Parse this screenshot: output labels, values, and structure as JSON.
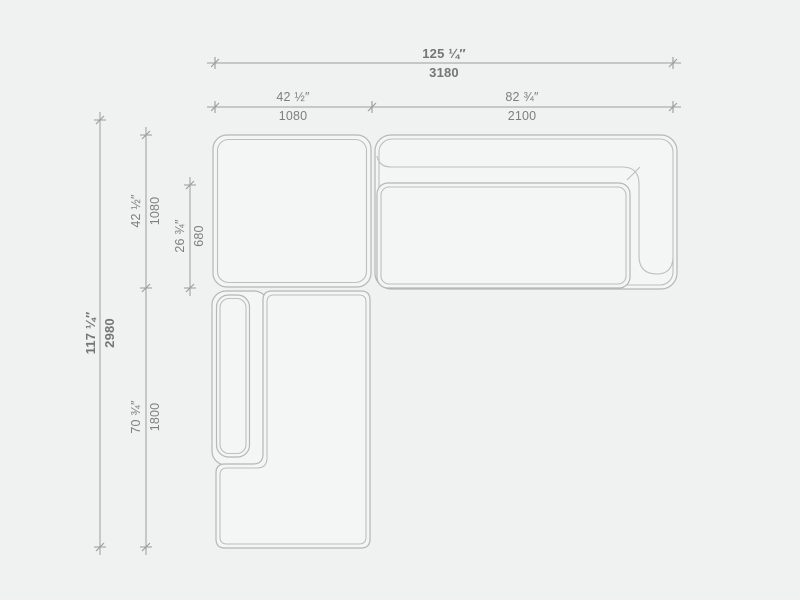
{
  "meta": {
    "title": "Sectional sofa — top view technical drawing",
    "view": "plan",
    "units": [
      "inches",
      "mm"
    ]
  },
  "drawing": {
    "colors": {
      "background": "#f0f1f1",
      "furniture_outline": "#b5b8b8",
      "dimension_line": "#9ba0a0",
      "label_text": "#7d8080"
    },
    "components": [
      "left-square-module",
      "right-sofa-module-with-back-and-arm",
      "right-module-seat-cushion",
      "bottom-chaise-module",
      "bottom-module-side-back-cushion"
    ],
    "dimensions": {
      "total_width": {
        "inches": "125 ¼″",
        "mm": "3180"
      },
      "left_module_width": {
        "inches": "42 ½″",
        "mm": "1080"
      },
      "right_module_width": {
        "inches": "82 ¾″",
        "mm": "2100"
      },
      "total_depth": {
        "inches": "117 ¼″",
        "mm": "2980"
      },
      "top_module_depth": {
        "inches": "42 ½″",
        "mm": "1080"
      },
      "seat_depth": {
        "inches": "26 ¾″",
        "mm": "680"
      },
      "chaise_module_depth": {
        "inches": "70 ¾″",
        "mm": "1800"
      }
    }
  }
}
